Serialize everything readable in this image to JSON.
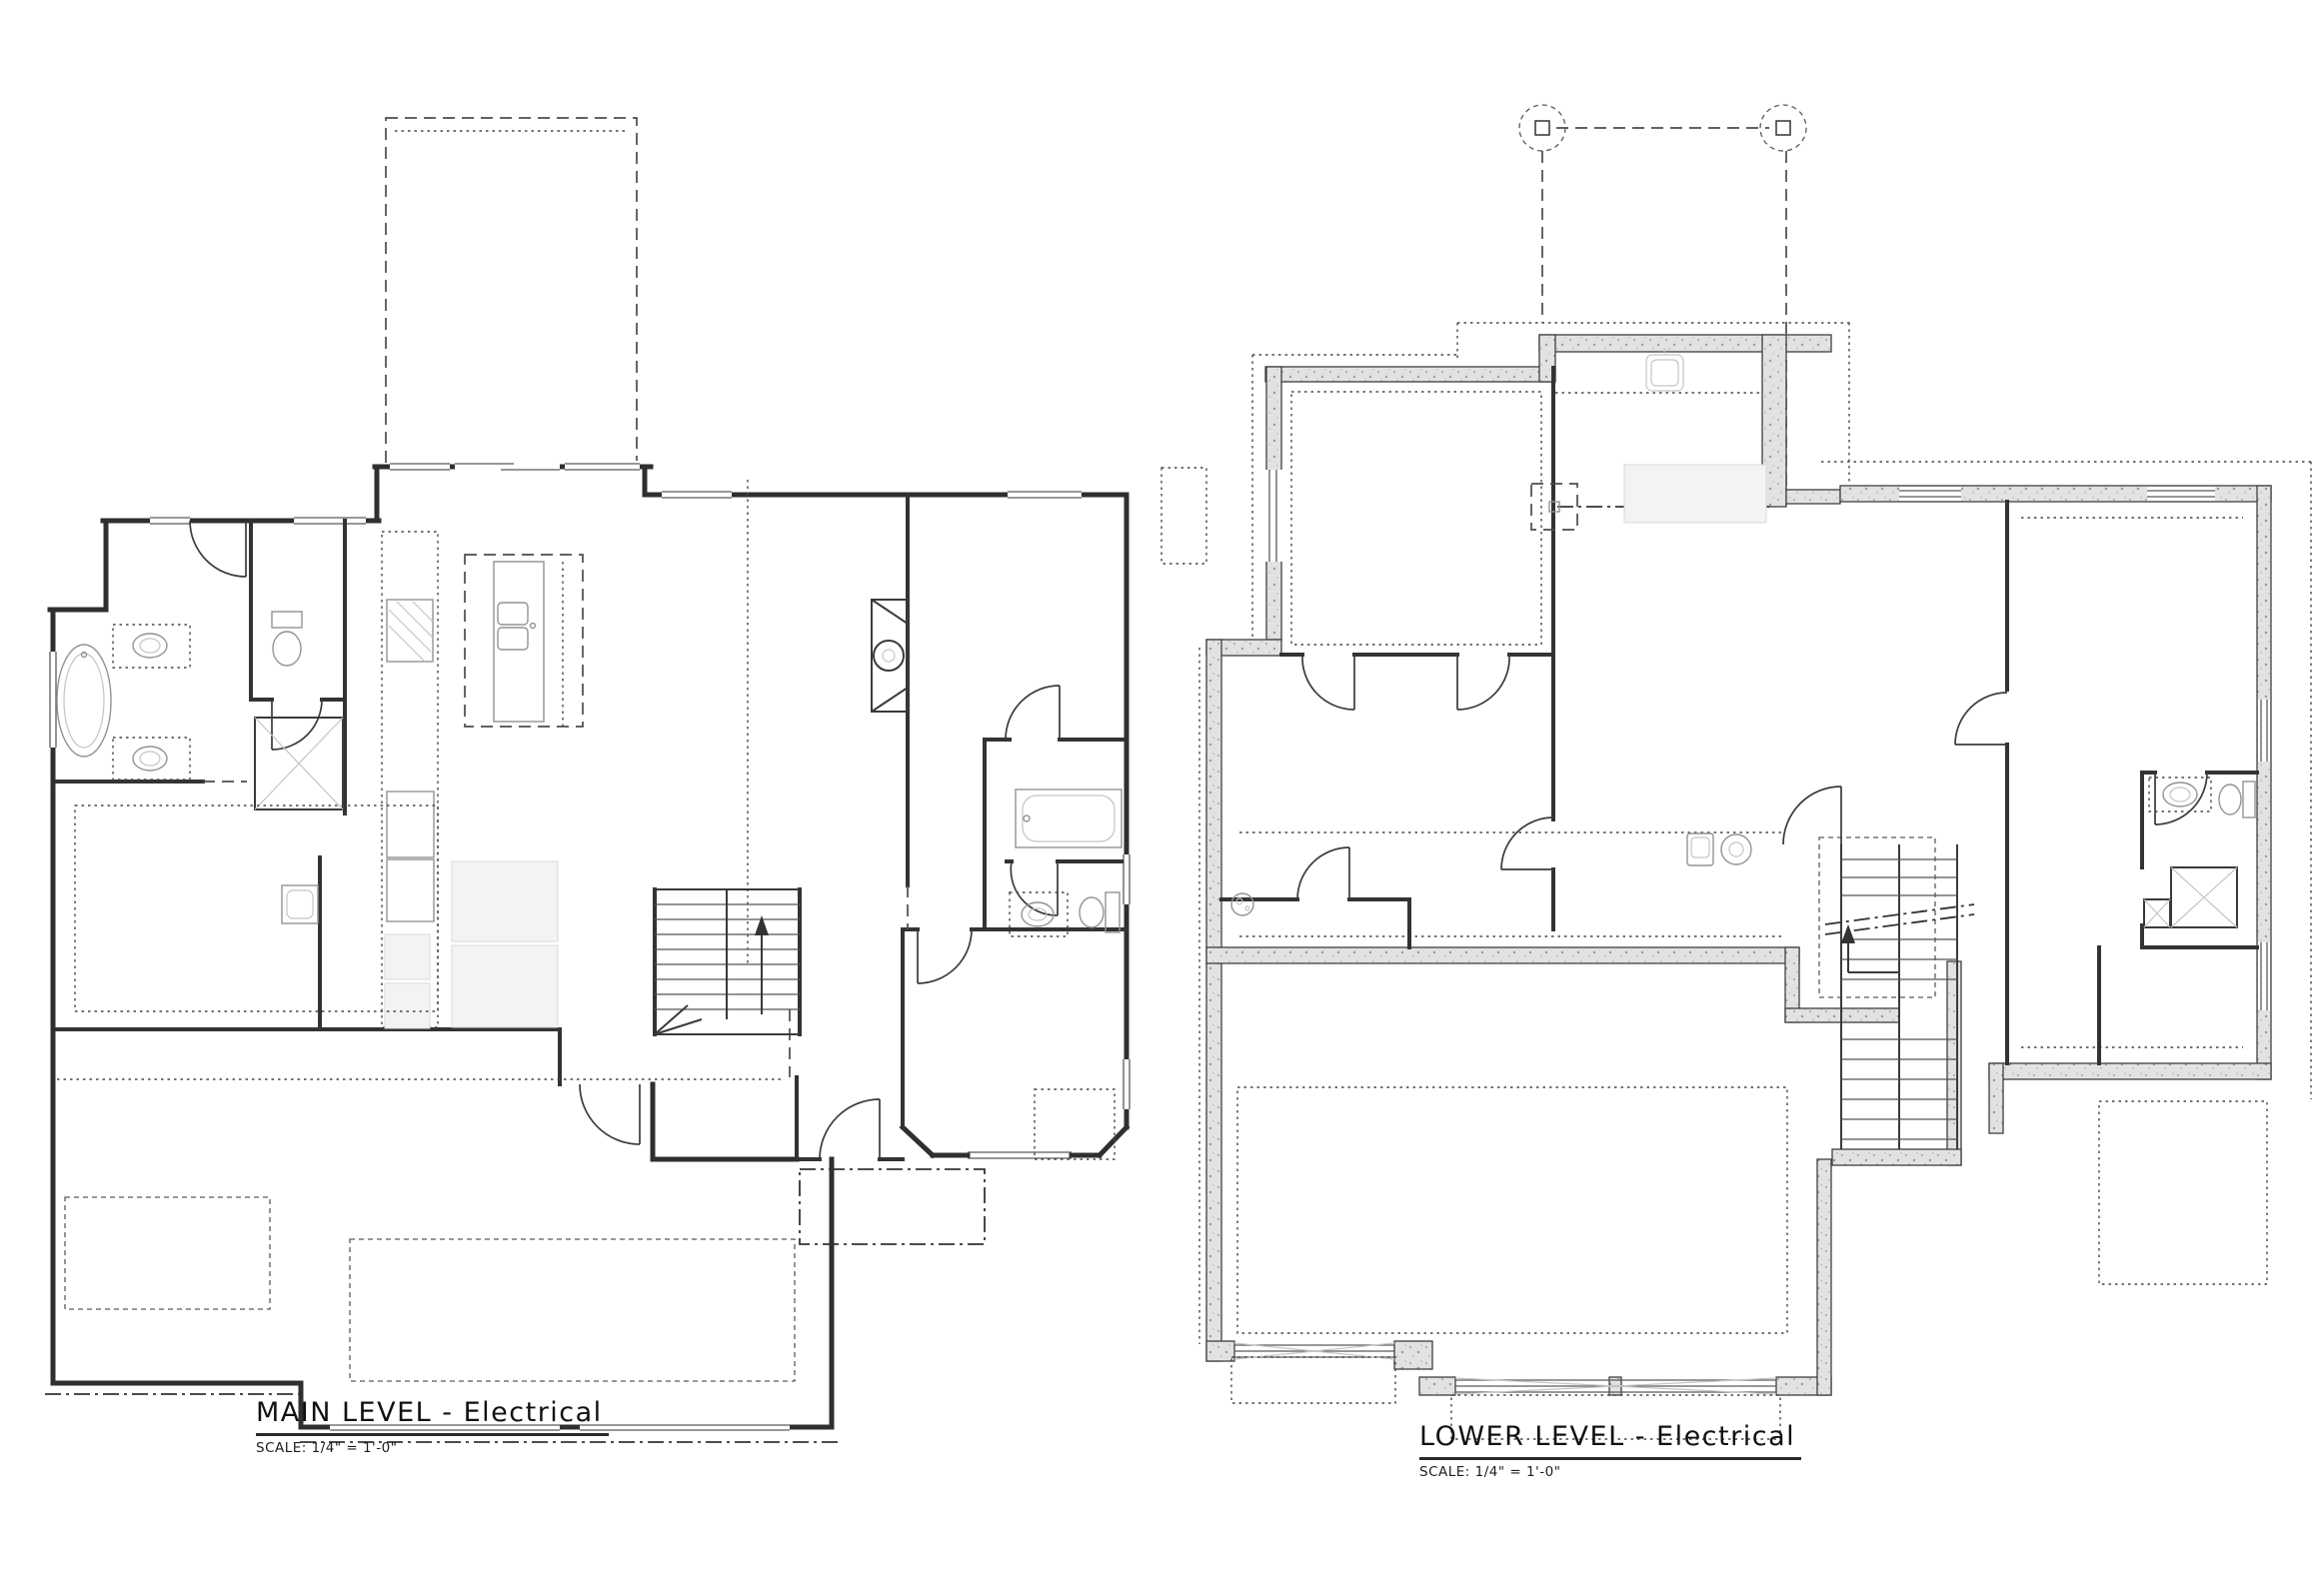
{
  "sheet": {
    "background": "#ffffff",
    "ink_color": "#2f2f2f",
    "concrete_fill": "#e2e2e2"
  },
  "plans": [
    {
      "id": "main-level",
      "title": "MAIN LEVEL - Electrical",
      "scale_note": "SCALE: 1/4\" = 1'-0\""
    },
    {
      "id": "lower-level",
      "title": "LOWER LEVEL - Electrical",
      "scale_note": "SCALE: 1/4\" = 1'-0\""
    }
  ]
}
